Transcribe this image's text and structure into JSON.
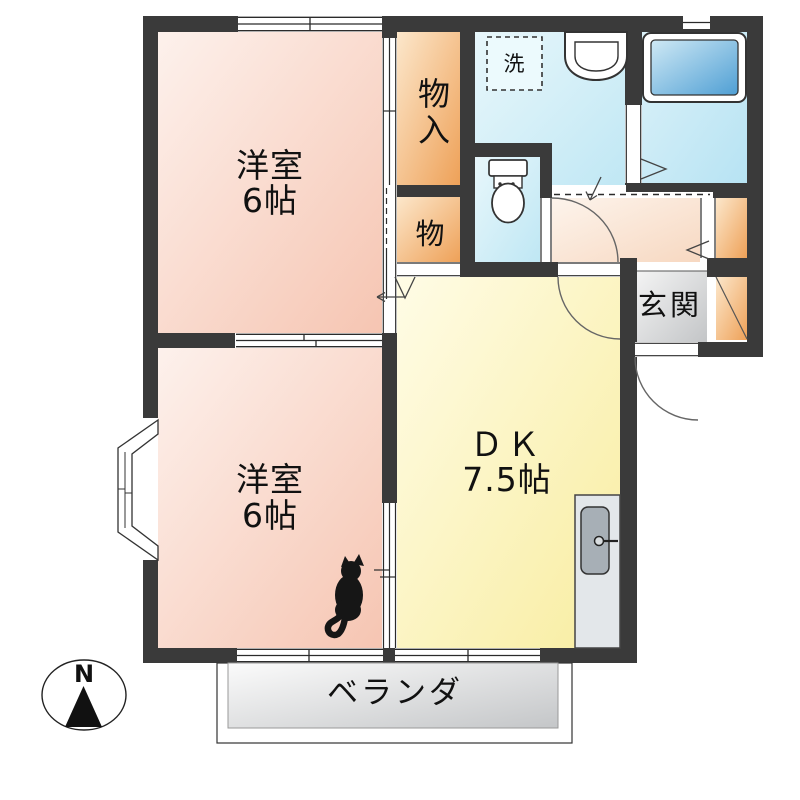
{
  "rooms": {
    "bedroom_top": {
      "name": "洋室",
      "size": "6帖"
    },
    "bedroom_bottom": {
      "name": "洋室",
      "size": "6帖"
    },
    "dining_kitchen": {
      "name": "ＤＫ",
      "size": "7.5帖"
    },
    "closet_top": {
      "label": "物入"
    },
    "closet_mid": {
      "label": "物"
    },
    "washer_box": {
      "label": "洗"
    },
    "entrance": {
      "label": "玄関"
    },
    "veranda": {
      "label": "ベランダ"
    }
  },
  "compass": {
    "north": "N"
  },
  "colors": {
    "wall": "#3a3a3a",
    "bedroom_floor": "#f6c5b2",
    "closet_floor": "#eea158",
    "wet_area_floor": "#bfe7f4",
    "bathtub_fill": "#4f9fd4",
    "dk_floor": "#f8eda0",
    "hall_floor": "#f7d8c1",
    "entrance_floor": "#c3c5c7",
    "veranda_deck": "#c4c6c8"
  }
}
